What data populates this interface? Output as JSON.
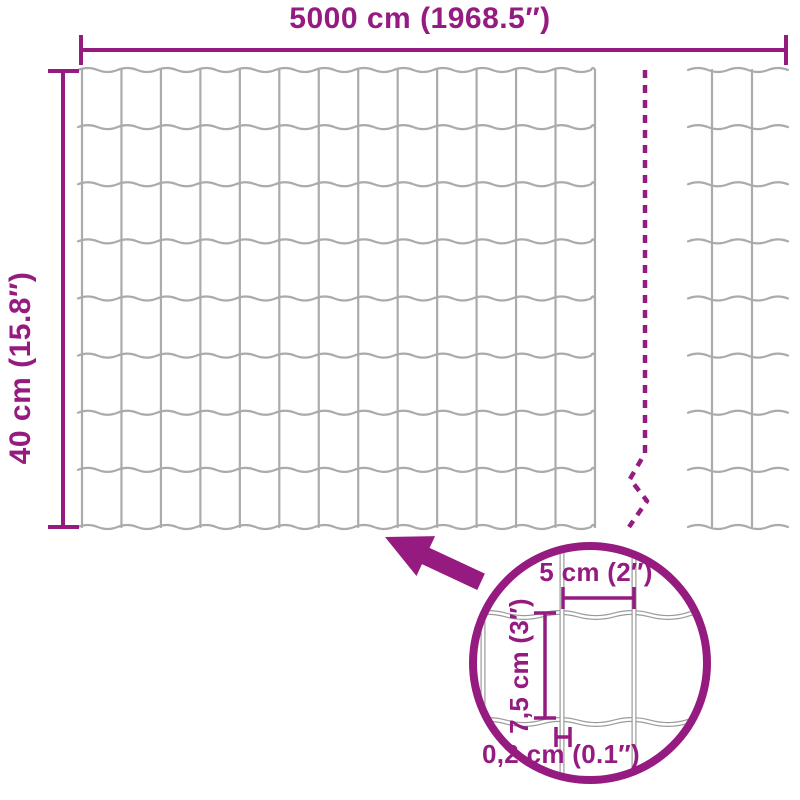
{
  "diagram": {
    "roll": {
      "length_label": "5000 cm (1968.5″)",
      "height_label": "40 cm (15.8″)"
    },
    "mesh_detail": {
      "cell_width_label": "5 cm (2″)",
      "cell_height_label": "7,5 cm (3″)",
      "wire_thickness_label": "0,2 cm (0.1″)"
    }
  },
  "colors": {
    "accent": "#951B81",
    "wire": "#ABABAB",
    "wire_detail": "#9A9A9A",
    "background": "#FFFFFF"
  }
}
